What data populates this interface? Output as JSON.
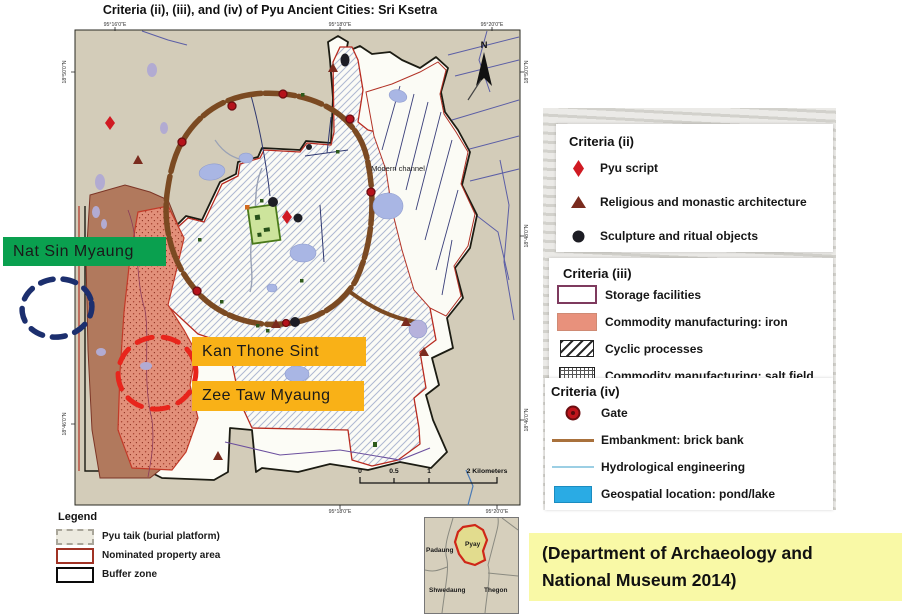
{
  "figure": {
    "title": "Criteria (ii), (iii), and (iv) of Pyu Ancient Cities: Sri Ksetra"
  },
  "map": {
    "coordinates": {
      "top": [
        "95°16'0\"E",
        "95°18'0\"E",
        "95°20'0\"E"
      ],
      "bottom": [
        "95°18'0\"E",
        "95°20'0\"E"
      ],
      "left": [
        "18°50'0\"N",
        "18°46'0\"N"
      ],
      "right": [
        "18°50'0\"N",
        "18°48'0\"N",
        "18°46'0\"N"
      ]
    },
    "north_label": "N",
    "modern_channel_label": "Modern channel",
    "scalebar": {
      "tick_0": "0",
      "tick_05": "0.5",
      "tick_1": "1",
      "end_label": "2 Kilometers"
    },
    "callouts": {
      "nat_sin_myaung": "Nat Sin Myaung",
      "kan_thone_sint": "Kan Thone Sint",
      "zee_taw_myaung": "Zee Taw Myaung"
    }
  },
  "legend": {
    "heading": "Legend",
    "items": [
      {
        "swatch": "dashed-outline",
        "label": "Pyu taik (burial platform)"
      },
      {
        "swatch": "red-outline",
        "label": "Nominated property area"
      },
      {
        "swatch": "black-outline",
        "label": "Buffer zone"
      }
    ]
  },
  "criteria_panel": {
    "sections": [
      {
        "heading": "Criteria (ii)",
        "items": [
          {
            "icon": "pyu-script-diamond",
            "label": "Pyu script"
          },
          {
            "icon": "architecture-triangle",
            "label": "Religious and monastic architecture"
          },
          {
            "icon": "sculpture-circle",
            "label": "Sculpture and ritual objects"
          }
        ]
      },
      {
        "heading": "Criteria (iii)",
        "items": [
          {
            "icon": "storage-swatch",
            "label": "Storage facilities"
          },
          {
            "icon": "iron-swatch",
            "label": "Commodity manufacturing: iron"
          },
          {
            "icon": "cyclic-hatch-swatch",
            "label": "Cyclic processes"
          },
          {
            "icon": "salt-grid-swatch",
            "label": "Commodity manufacturing: salt field"
          }
        ]
      },
      {
        "heading": "Criteria (iv)",
        "items": [
          {
            "icon": "gate-dot",
            "label": "Gate"
          },
          {
            "icon": "embankment-line",
            "label": "Embankment: brick bank"
          },
          {
            "icon": "hydrological-line",
            "label": "Hydrological engineering"
          },
          {
            "icon": "pond-swatch",
            "label": "Geospatial location: pond/lake"
          }
        ]
      }
    ]
  },
  "inset_map": {
    "regions": {
      "padaung": "Padaung",
      "pyay": "Pyay",
      "shwedaung": "Shwedaung",
      "thegon": "Thegon"
    }
  },
  "citation": {
    "line1": "(Department of Archaeology and",
    "line2": "National Museum 2014)"
  },
  "colors": {
    "callout_green": "#0aa04f",
    "callout_orange": "#f9b117",
    "citation_yellow": "#f9f9a6",
    "map_background": "#d3ccb9",
    "iron_area": "#e2907a",
    "pond_blue": "#a9b6e4",
    "legend_pond_blue": "#2aabe4",
    "embankment_brown": "#7b4a22",
    "gate_red": "#b5121b",
    "pyu_script_red": "#d01a22",
    "architecture_brown": "#7a2b1e",
    "navy_dashed_circle": "#1c2f6e",
    "red_dashed_circle": "#e8251c"
  }
}
